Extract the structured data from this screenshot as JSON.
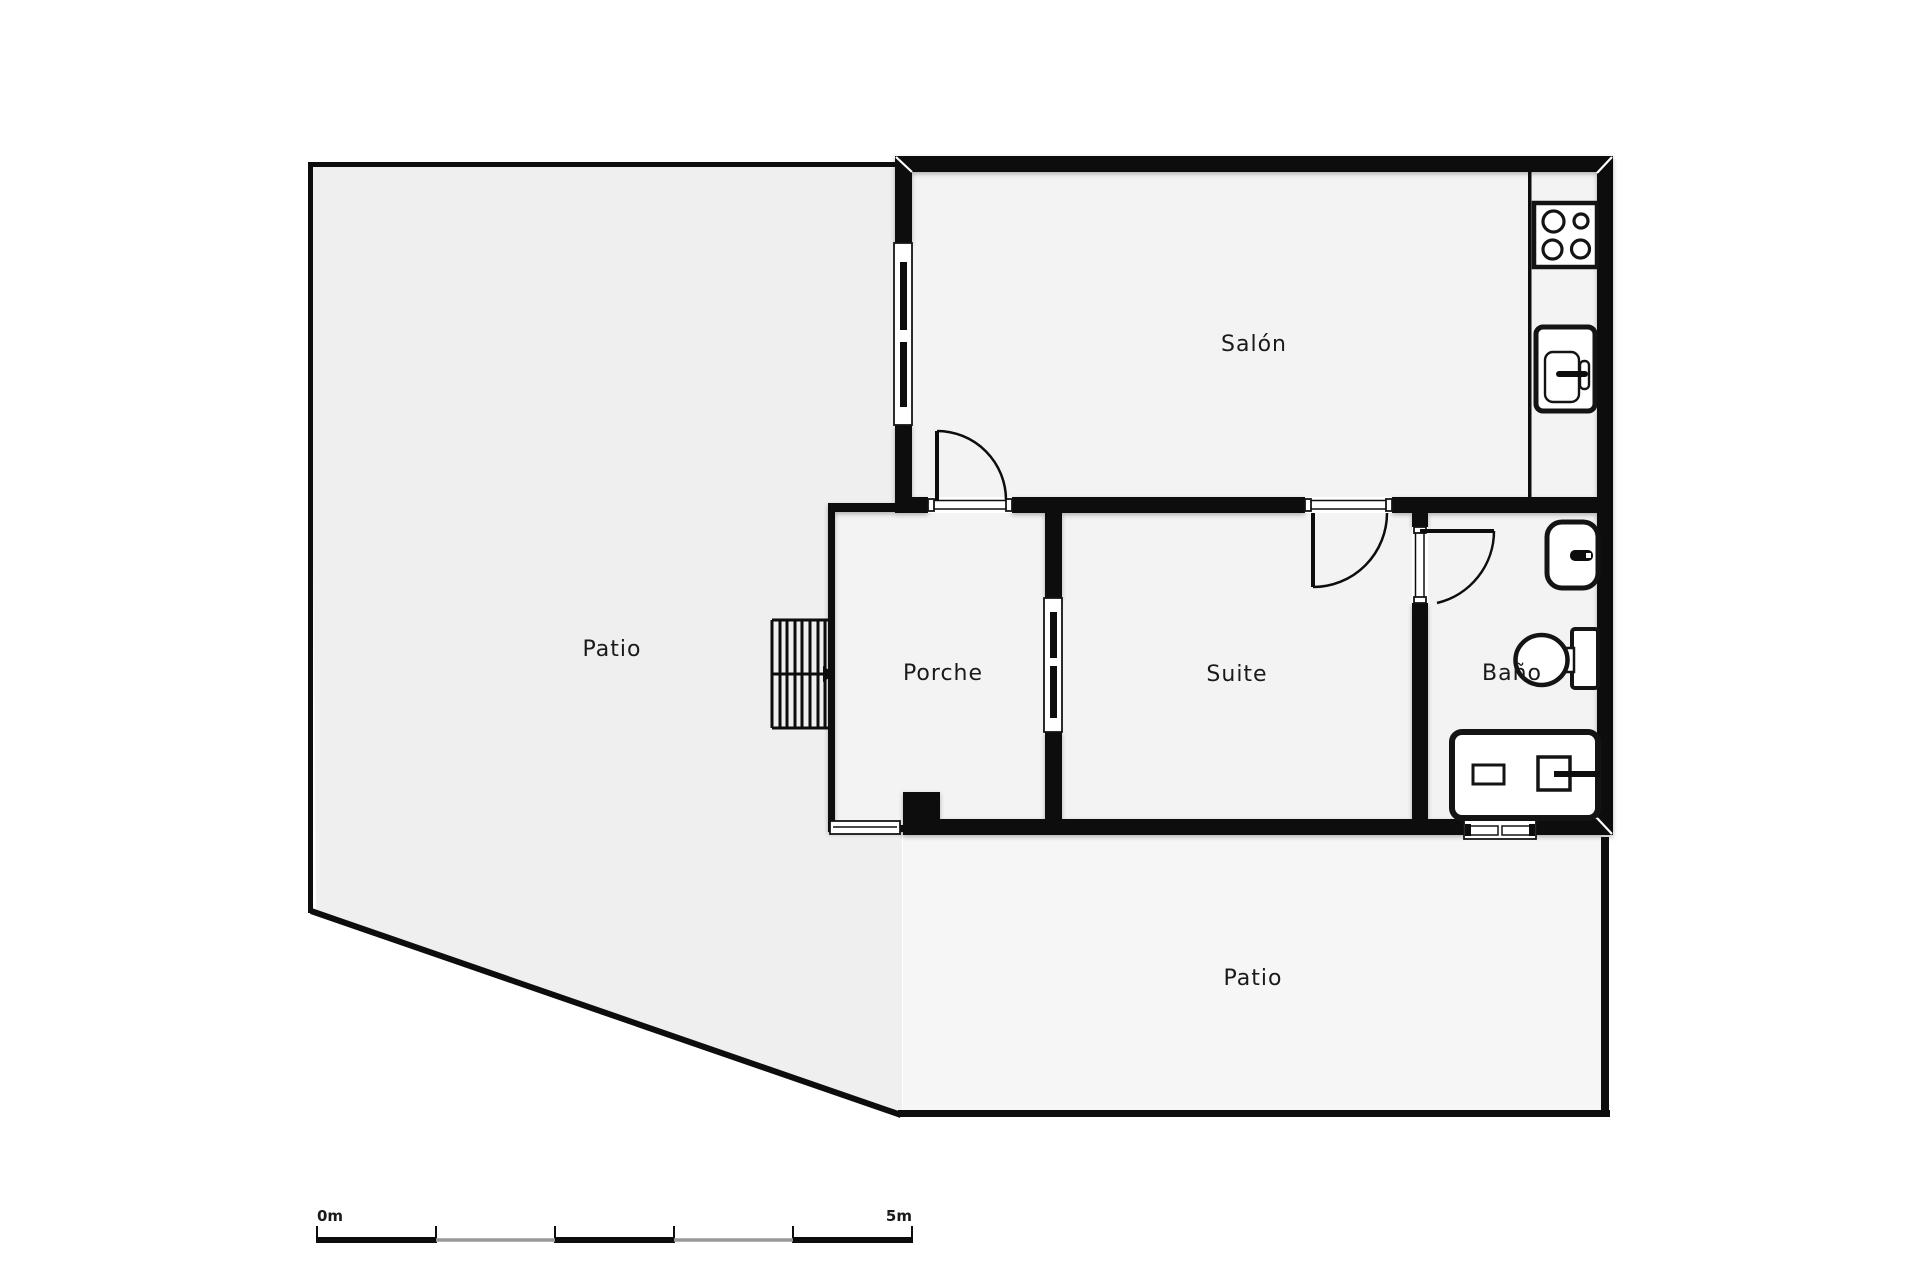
{
  "title": "Floor plan",
  "colors": {
    "background": "#ffffff",
    "wall": "#0d0d0d",
    "line": "#141414",
    "room_fill": "#f3f3f3",
    "patio_left_fill": "#efefef",
    "patio_bottom_fill": "#f6f6f6",
    "scale_gray": "#999999",
    "text": "#1a1a1a"
  },
  "rooms": {
    "salon": {
      "label": "Salón"
    },
    "porche": {
      "label": "Porche"
    },
    "suite": {
      "label": "Suite"
    },
    "bano": {
      "label": "Baño"
    },
    "patio_left": {
      "label": "Patio"
    },
    "patio_bottom": {
      "label": "Patio"
    }
  },
  "fixtures": {
    "kitchen": {
      "stove": "stove-4-burner-icon",
      "sink": "kitchen-sink-icon",
      "counter": "kitchen-counter"
    },
    "bathroom": {
      "washbasin": "washbasin-icon",
      "toilet": "toilet-icon",
      "vanity": "vanity-unit-icon"
    },
    "porch": {
      "stairs": "staircase-icon"
    },
    "door_count": 3,
    "window_count": 4
  },
  "scale_bar": {
    "start_label": "0m",
    "end_label": "5m",
    "segments": 5
  }
}
